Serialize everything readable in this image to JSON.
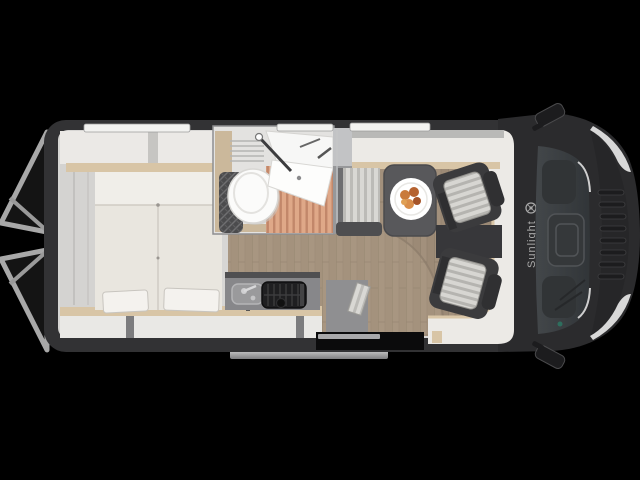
{
  "scene": {
    "brand_label": "Sunlight",
    "brand_color": "#a9a9a9",
    "background_color": "#000000",
    "view": "camper-van-floor-plan-top-view",
    "palette": {
      "body_shell": "#323234",
      "cab_hood": "#2b2b2d",
      "interior_wall": "#d7d6d4",
      "bed_mattress": "#e9e6df",
      "wood_trim": "#d8c5a6",
      "wood_floor": "#a2907c",
      "shower_slats": "#dfa888",
      "table": "#58585b",
      "seat_shell": "#3b3b3d",
      "seat_cushion": "#d7d6d2",
      "entry_step": "#c2c2c2"
    },
    "component_names": [
      "rear-doors-open",
      "rear-bed",
      "bed-pillows",
      "overhead-cabinets",
      "bathroom",
      "toilet",
      "fold-down-sink",
      "shower-slat-floor",
      "wardrobe-cabinet",
      "kitchen-sink",
      "kitchen-stove",
      "kitchen-counter",
      "dinette-table",
      "dinette-bench",
      "food-plate",
      "entry-bench",
      "passenger-swivel-seat",
      "driver-swivel-seat",
      "cab-windshield",
      "side-mirror-left",
      "side-mirror-right",
      "headlights",
      "entry-step",
      "entry-door-opening"
    ]
  }
}
